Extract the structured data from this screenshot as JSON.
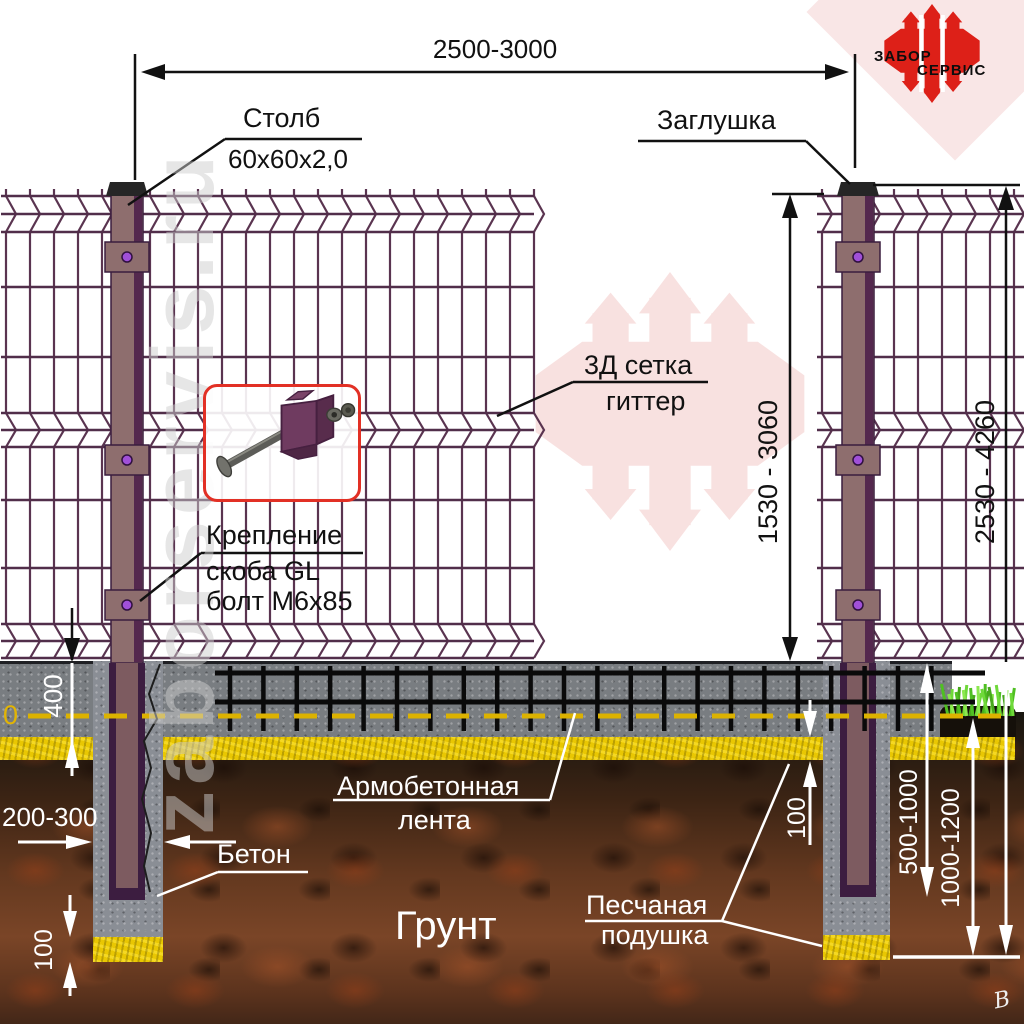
{
  "logo": {
    "line1": "ЗАБОР",
    "line2": "СЕРВИС"
  },
  "watermark": "zaborservis.ru",
  "artist_mark": "В",
  "dimensions": {
    "span": "2500-3000",
    "mesh_height": "1530 - 3060",
    "post_total_height": "2530 - 4260",
    "strip_depth": "400",
    "zero_level": "0",
    "pillar_width": "200-300",
    "sand_layer": "100",
    "post_embed_depth": "500-1000",
    "pit_depth": "1000-1200",
    "sand_pad": "100"
  },
  "labels": {
    "post": "Столб",
    "post_size": "60x60x2,0",
    "cap": "Заглушка",
    "mesh_line1": "3Д сетка",
    "mesh_line2": "гиттер",
    "bracket_line1": "Крепление",
    "bracket_line2": "скоба GL",
    "bracket_line3": "болт М6х85",
    "strip_line1": "Армобетонная",
    "strip_line2": "лента",
    "concrete": "Бетон",
    "soil": "Грунт",
    "sand_line1": "Песчаная",
    "sand_line2": "подушка"
  },
  "colors": {
    "mesh_wire": "#5a3450",
    "post_body": "#8e6e6e",
    "post_edge": "#3a1d3e",
    "bolt": "#a050d8",
    "logo_red": "#dd2018",
    "pale_pink": "#f8dedd",
    "concrete": "#797d81",
    "pillar": "#8a8e95",
    "sand": "#e9c702",
    "rebar": "#0a0a0a",
    "zero_line": "#dcb200",
    "grass": "#5fcf2b",
    "dim_white": "#ffffff"
  }
}
